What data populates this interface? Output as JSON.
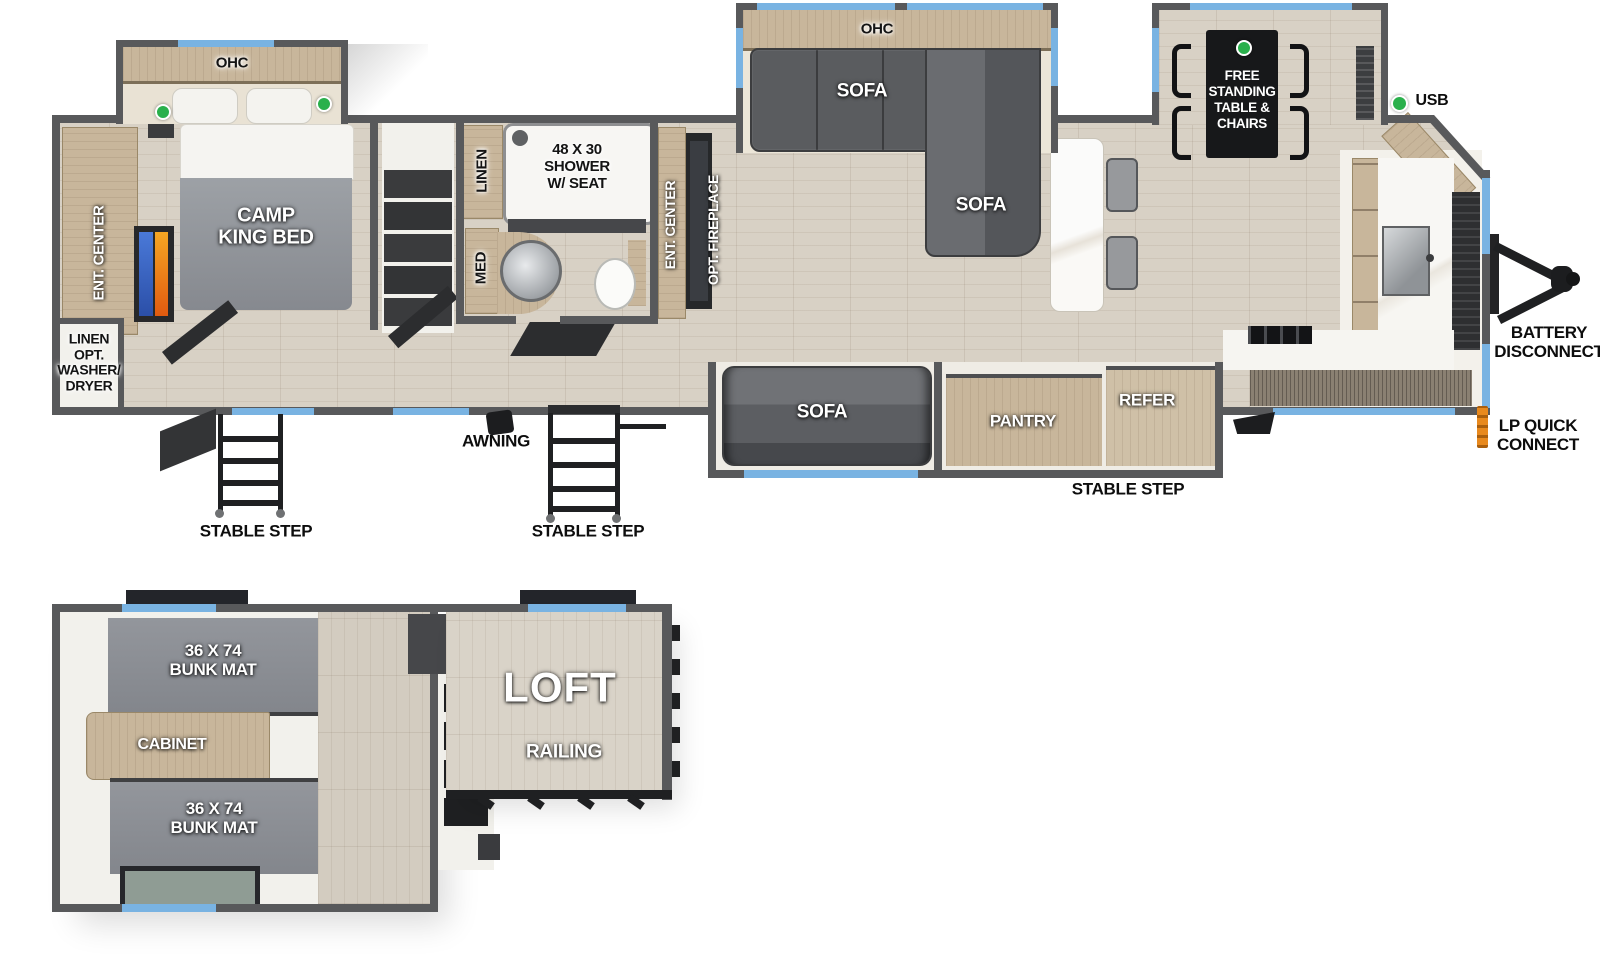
{
  "colors": {
    "window_blue": "#79b3e2",
    "indicator_green": "#2ab04c",
    "lp_orange": "#e8891d",
    "wall_gray": "#58595b"
  },
  "main_plan": {
    "bedroom": {
      "ohc": "OHC",
      "bed": "CAMP\nKING BED",
      "ent_center": "ENT. CENTER",
      "linen_washer": "LINEN\nOPT.\nWASHER/\nDRYER"
    },
    "bathroom": {
      "linen": "LINEN",
      "shower": "48 X 30\nSHOWER\nW/ SEAT",
      "med": "MED"
    },
    "living": {
      "ent_center": "ENT. CENTER",
      "fireplace": "OPT. FIREPLACE",
      "ohc": "OHC",
      "sofa_rear": "SOFA",
      "sofa_chaise": "SOFA",
      "sofa_front": "SOFA"
    },
    "kitchen": {
      "pantry": "PANTRY",
      "refer": "REFER",
      "table": "FREE\nSTANDING\nTABLE &\nCHAIRS"
    },
    "exterior": {
      "stable_step_rear": "STABLE STEP",
      "stable_step_mid": "STABLE STEP",
      "stable_step_front": "STABLE STEP",
      "awning": "AWNING",
      "usb": "USB",
      "battery_disconnect": "BATTERY\nDISCONNECT",
      "lp_quick_connect": "LP QUICK\nCONNECT"
    }
  },
  "loft_plan": {
    "bunk_rear": "36 X 74\nBUNK MAT",
    "bunk_front": "36 X 74\nBUNK MAT",
    "cabinet": "CABINET",
    "loft": "LOFT",
    "railing": "RAILING"
  }
}
